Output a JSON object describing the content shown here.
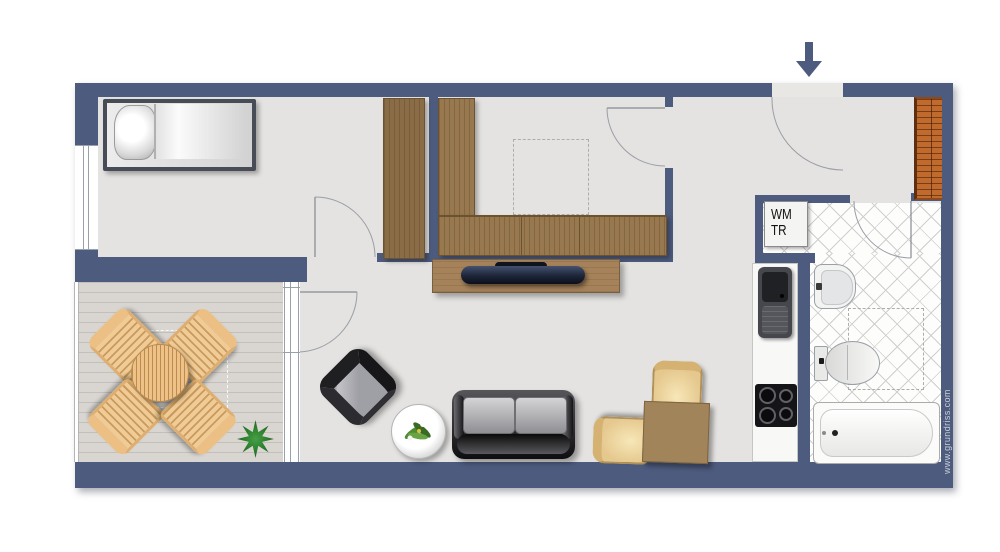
{
  "watermark": "www.grundriss.com",
  "utility_labels": {
    "washing_machine": "WM",
    "dryer": "TR"
  },
  "icons": {
    "entry_arrow": "arrow-down-icon",
    "plant": "potted-plant",
    "flowers": "flower-decoration"
  },
  "colors": {
    "wall": "#4d5b7e",
    "floor": "#e4e3e1",
    "terrace_floor": "#d9d6d2",
    "tile_line": "#cfcfcf",
    "wood_dark": "#8a6c47",
    "wood_mid": "#97784f",
    "wood_sideboard": "#a5825a",
    "radiator": "#c06a2e",
    "terrace_wood": "#eec189"
  }
}
